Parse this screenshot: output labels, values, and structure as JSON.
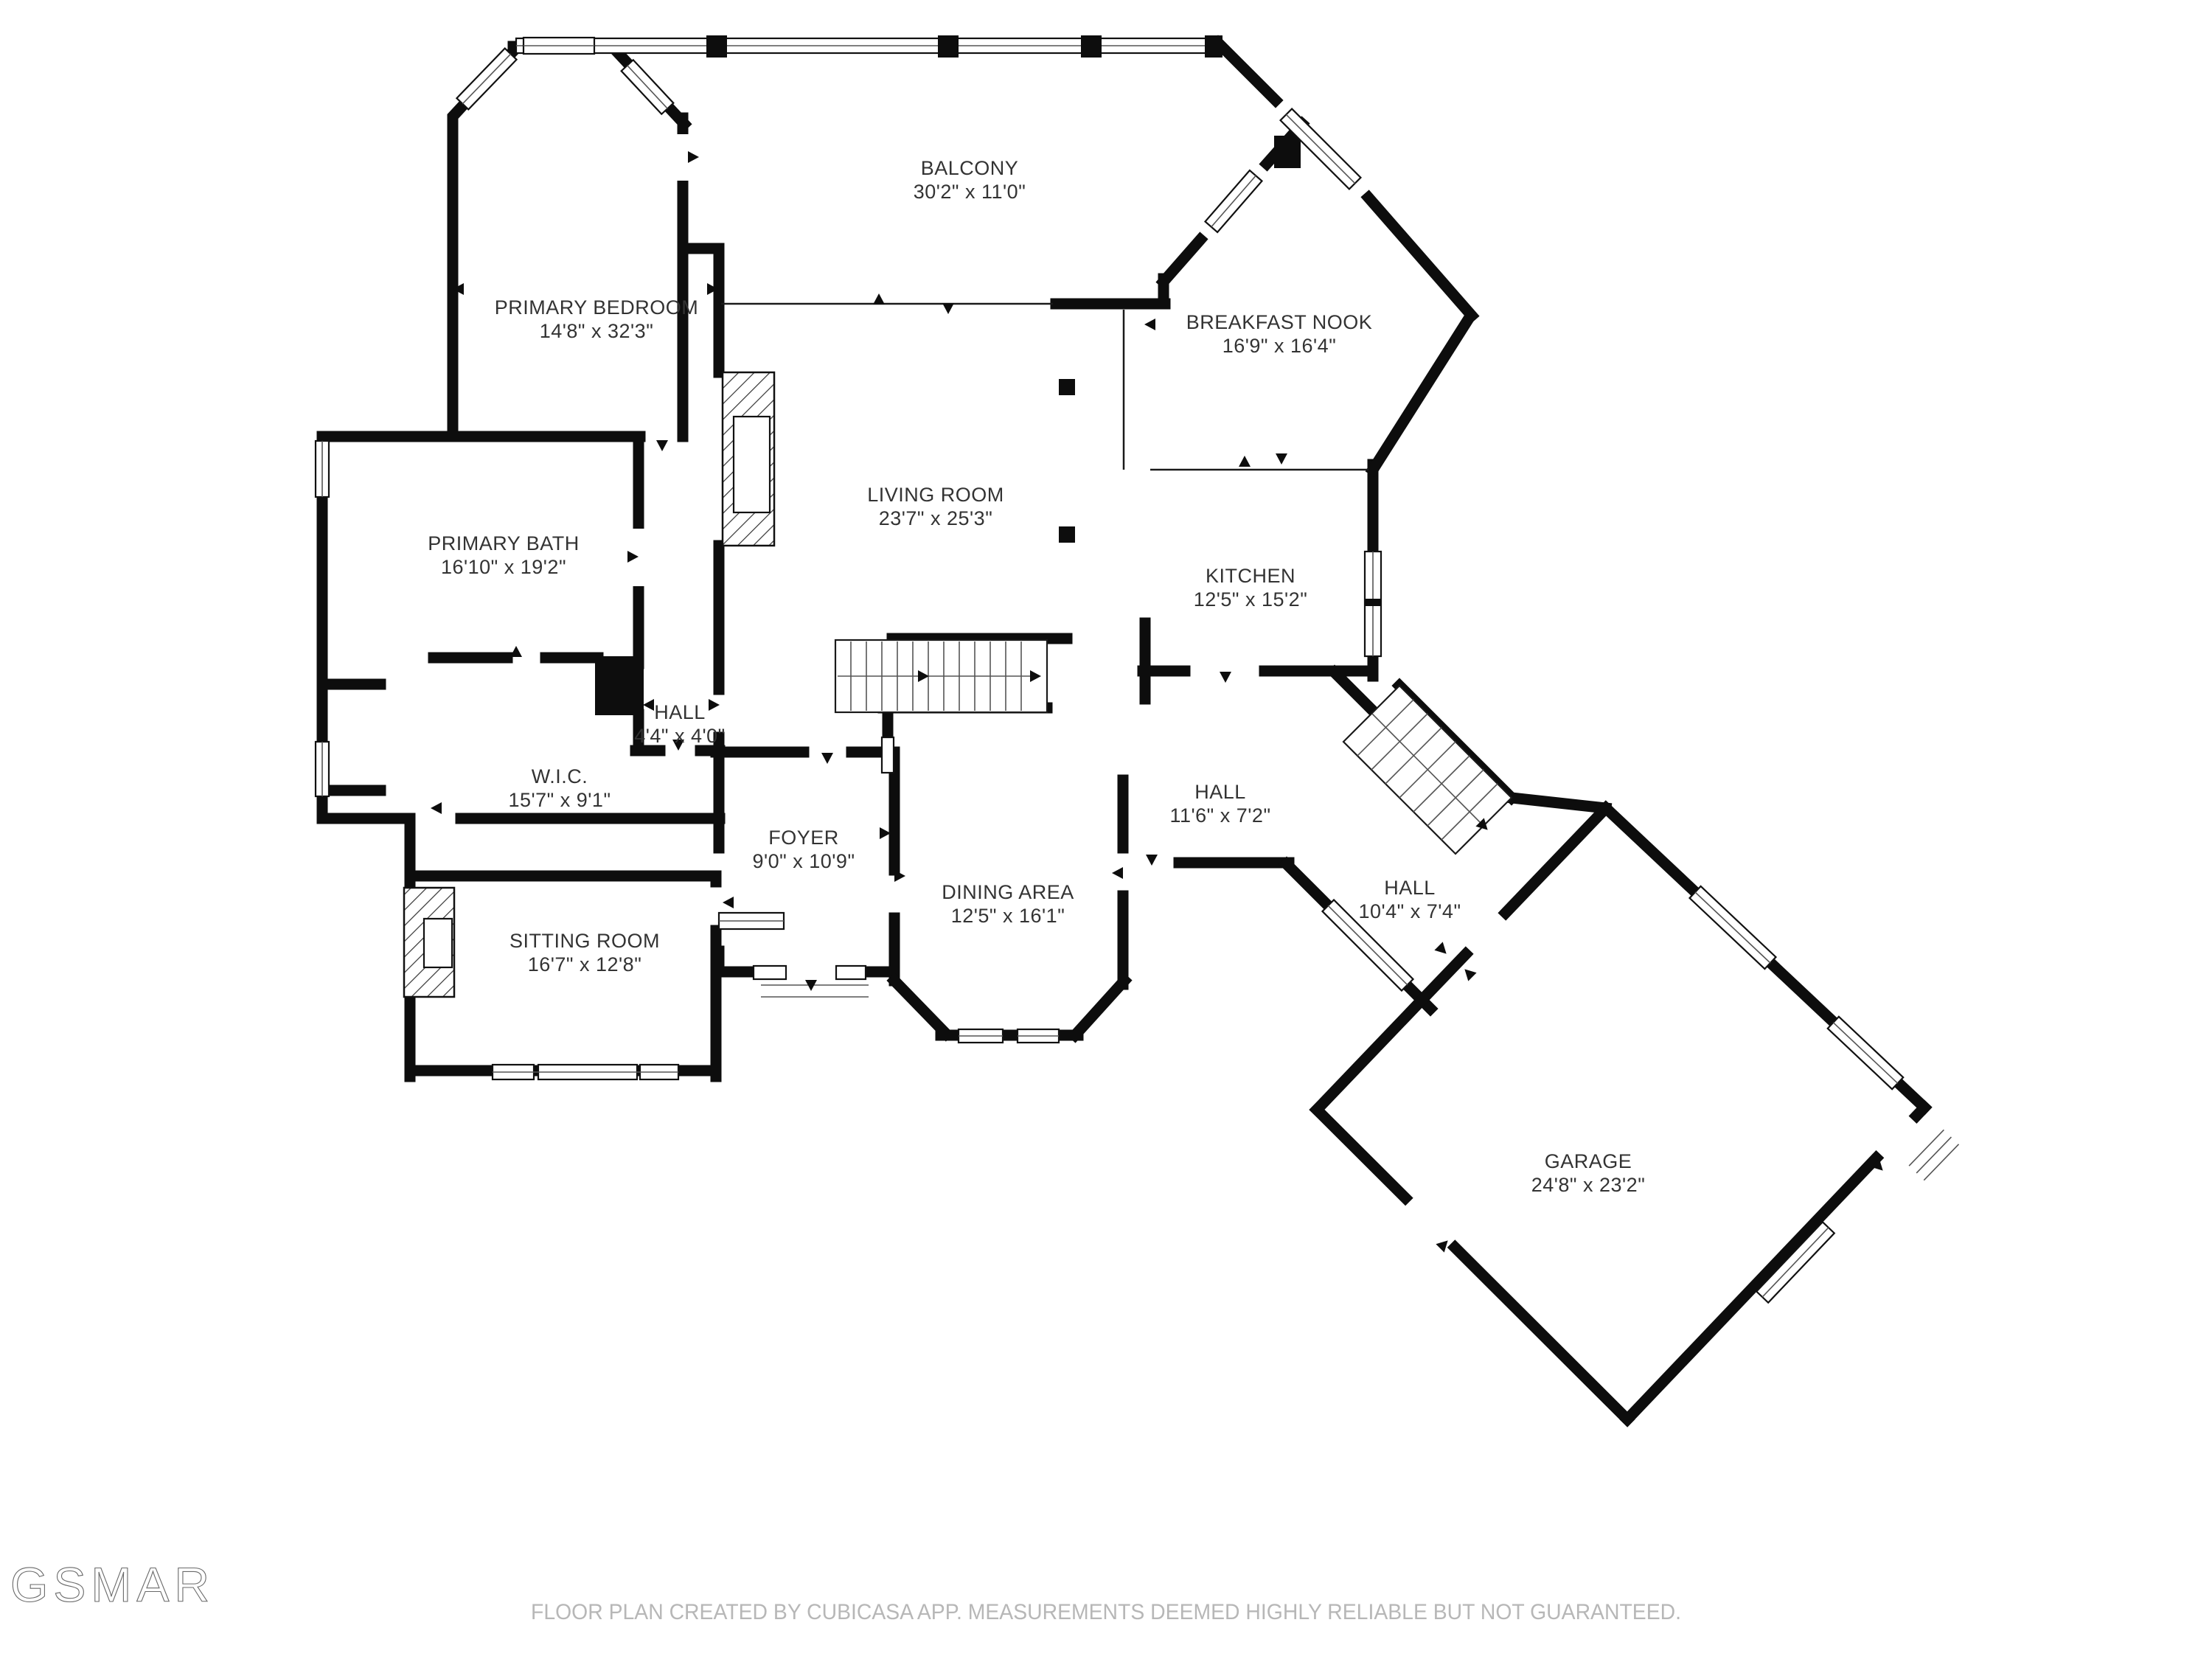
{
  "plan": {
    "rooms": [
      {
        "name": "BALCONY",
        "dims": "30'2\" x 11'0\""
      },
      {
        "name": "PRIMARY BEDROOM",
        "dims": "14'8\" x 32'3\""
      },
      {
        "name": "BREAKFAST NOOK",
        "dims": "16'9\" x 16'4\""
      },
      {
        "name": "LIVING ROOM",
        "dims": "23'7\" x 25'3\""
      },
      {
        "name": "PRIMARY BATH",
        "dims": "16'10\" x 19'2\""
      },
      {
        "name": "KITCHEN",
        "dims": "12'5\" x 15'2\""
      },
      {
        "name": "HALL",
        "dims": "4'4\" x 4'0\""
      },
      {
        "name": "W.I.C.",
        "dims": "15'7\" x 9'1\""
      },
      {
        "name": "FOYER",
        "dims": "9'0\" x 10'9\""
      },
      {
        "name": "DINING AREA",
        "dims": "12'5\" x 16'1\""
      },
      {
        "name": "HALL",
        "dims": "11'6\" x 7'2\""
      },
      {
        "name": "HALL",
        "dims": "10'4\" x 7'4\""
      },
      {
        "name": "SITTING ROOM",
        "dims": "16'7\" x 12'8\""
      },
      {
        "name": "GARAGE",
        "dims": "24'8\" x 23'2\""
      }
    ],
    "watermark": "GSMAR",
    "disclaimer": "FLOOR PLAN CREATED BY CUBICASA APP. MEASUREMENTS DEEMED HIGHLY RELIABLE BUT NOT GUARANTEED.",
    "colors": {
      "wall": "#0d0d0d",
      "label": "#333333",
      "muted": "#b7b7b7"
    }
  }
}
